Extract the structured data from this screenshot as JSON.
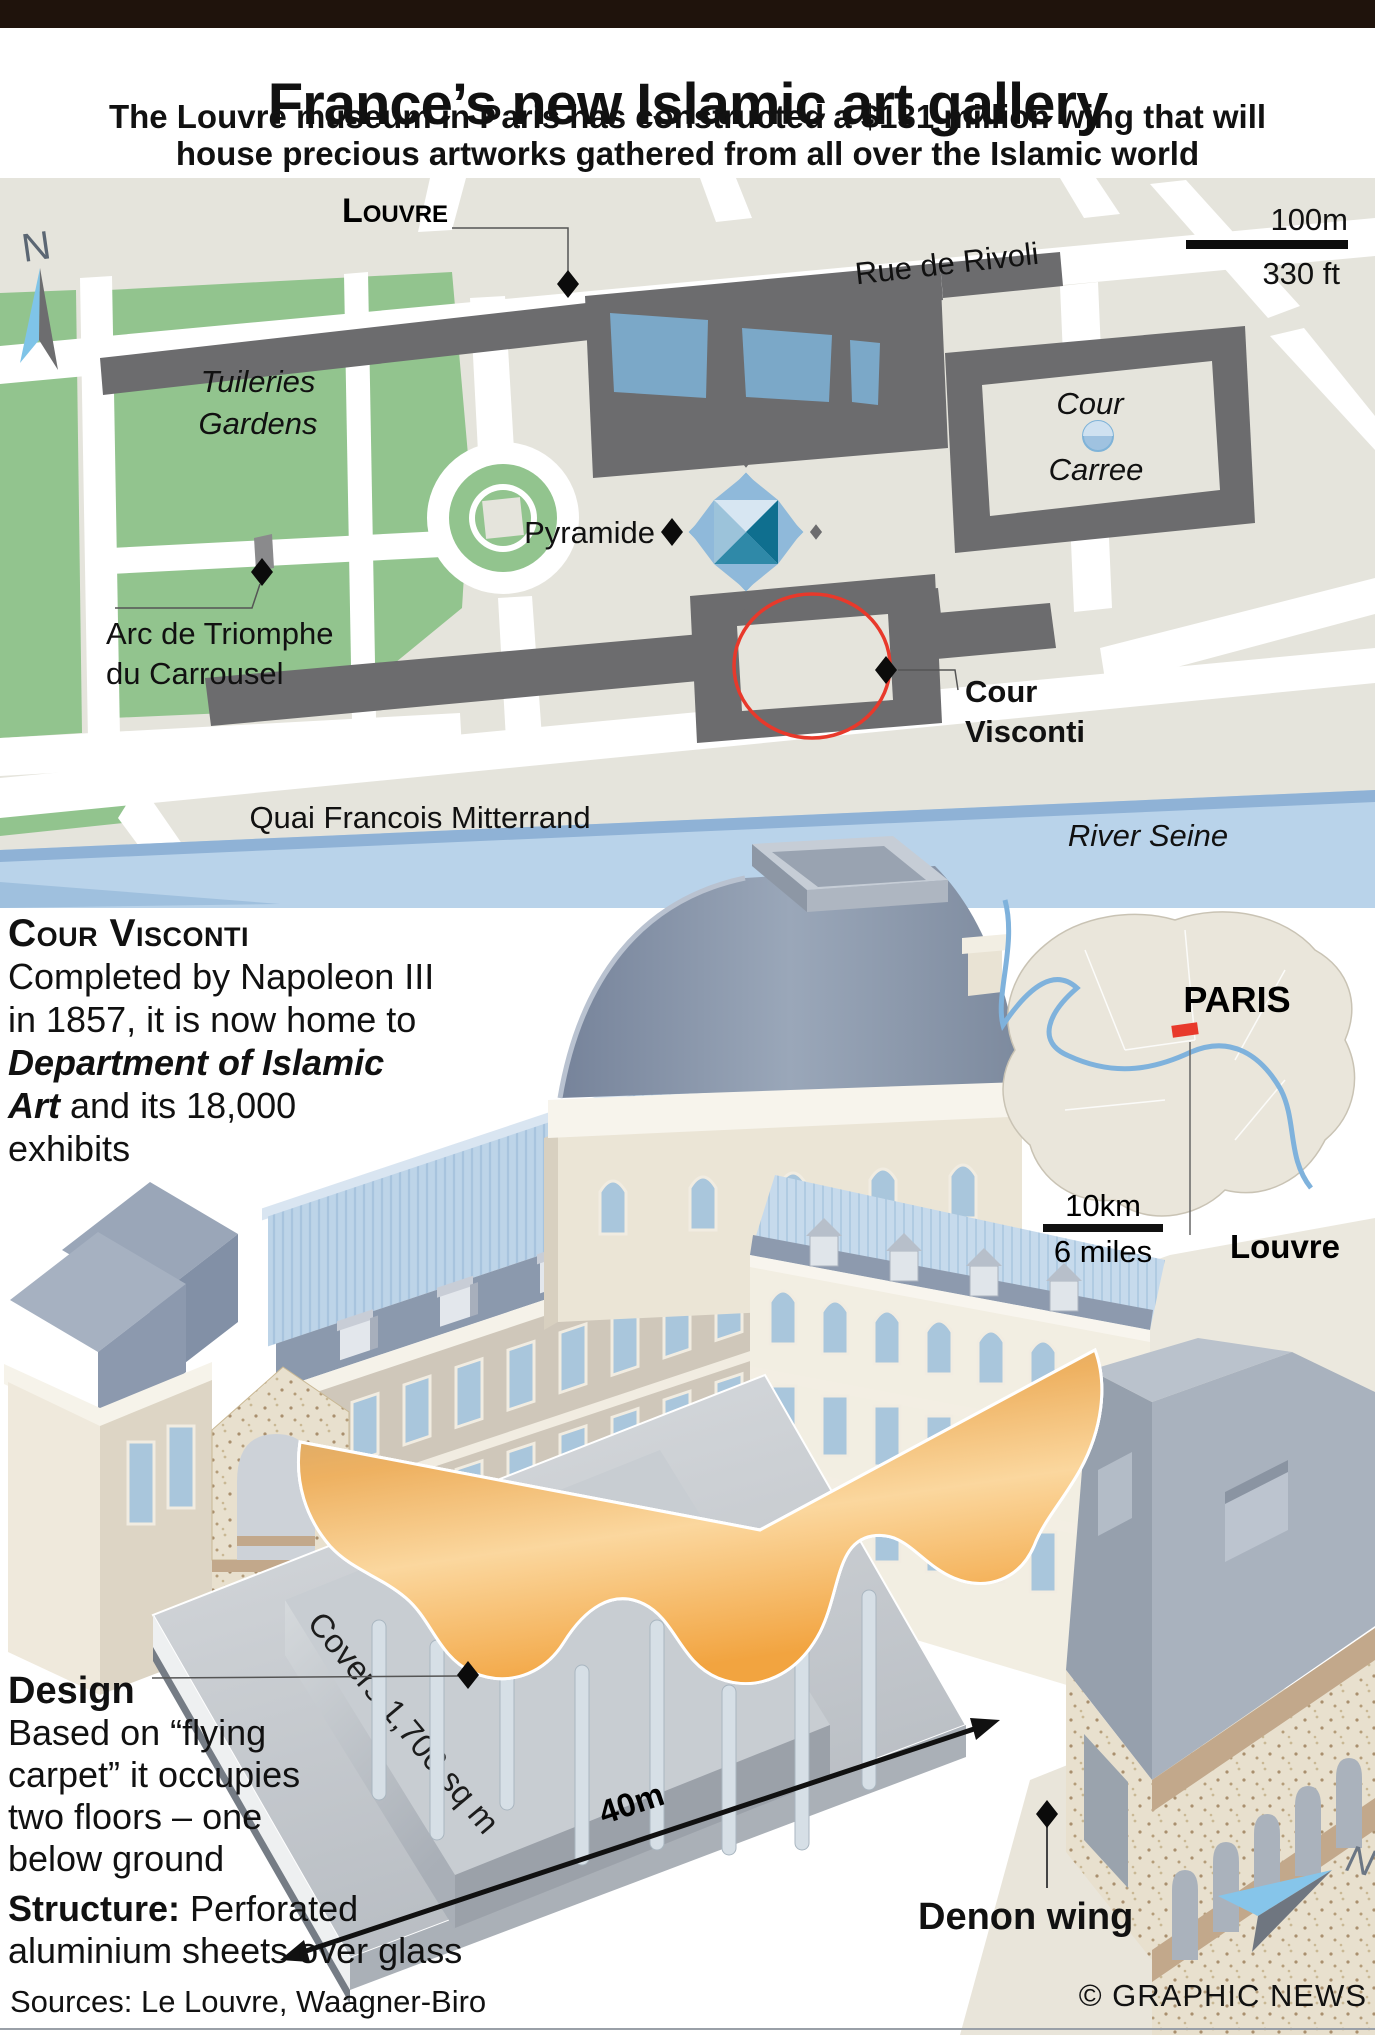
{
  "header": {
    "title": "France’s new Islamic art gallery",
    "subtitle_line1": "The Louvre museum in Paris has constructed a $131 million wing that will",
    "subtitle_line2": "house precious artworks gathered from all over the Islamic world"
  },
  "map": {
    "labels": {
      "louvre": "Louvre",
      "rue_de_rivoli": "Rue de Rivoli",
      "tuileries_line1": "Tuileries",
      "tuileries_line2": "Gardens",
      "pyramide": "Pyramide",
      "cour_carree_line1": "Cour",
      "cour_carree_line2": "Carree",
      "arc_line1": "Arc de Triomphe",
      "arc_line2": "du Carrousel",
      "cour_visconti_line1": "Cour",
      "cour_visconti_line2": "Visconti",
      "quai": "Quai Francois Mitterrand",
      "river": "River Seine",
      "compass_n": "N"
    },
    "scale": {
      "metric": "100m",
      "imperial": "330 ft"
    }
  },
  "visconti_note": {
    "heading": "Cour Visconti",
    "line1": "Completed by Napoleon III",
    "line2": "in 1857, it is now home to",
    "line3_bold": "Department of Islamic",
    "line4_bold": "Art",
    "line4_rest": " and its 18,000",
    "line5": "exhibits"
  },
  "paris_inset": {
    "city": "PARIS",
    "landmark": "Louvre",
    "scale": {
      "metric": "10km",
      "imperial": "6 miles"
    }
  },
  "diagram": {
    "covers": "Covers 1,700 sq m",
    "width_label": "40m",
    "denon_wing": "Denon wing",
    "compass_n": "N",
    "design_heading": "Design",
    "design_line1": "Based on “flying",
    "design_line2": "carpet” it occupies",
    "design_line3": "two floors – one",
    "design_line4": "below ground",
    "structure_heading": "Structure:",
    "structure_rest": " Perforated",
    "structure_line2": "aluminium sheets over glass"
  },
  "footer": {
    "sources": "Sources: Le Louvre, Waagner-Biro",
    "credit": "© GRAPHIC NEWS"
  },
  "colors": {
    "title_bar": "#1f130c",
    "accent_red": "#e8392b",
    "map_green": "#92c48e",
    "building_gray": "#6c6c6e",
    "water_blue": "#b9d3ea",
    "pool_blue": "#7ba8c8",
    "roof_blue": "#bdd4e8",
    "roof_slate": "#8b99ad",
    "carpet_orange": "#f2ae52",
    "river_label_blue": "#2a9fd8"
  }
}
